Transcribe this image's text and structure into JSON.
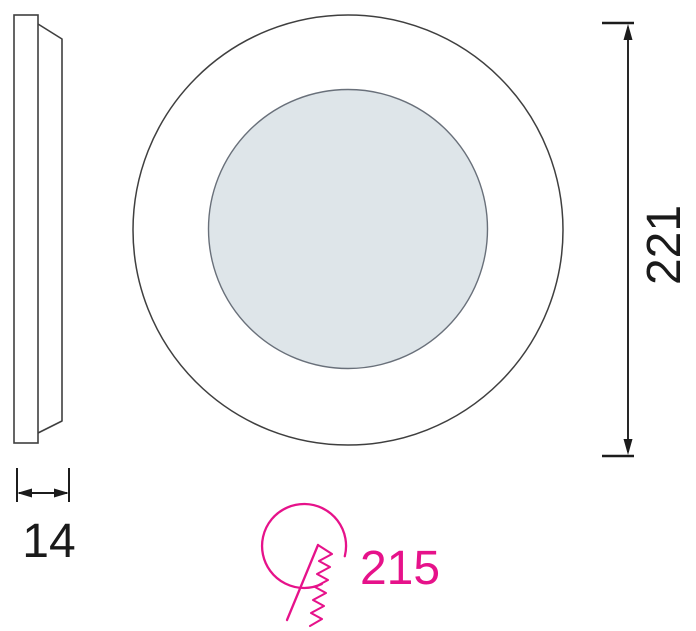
{
  "drawing": {
    "kind": "technical-dimension-drawing",
    "dimensions": {
      "thickness": "14",
      "diameter": "221",
      "cutout": "215"
    },
    "colors": {
      "line": "#3f3f3f",
      "dim_line": "#1c1c1c",
      "text": "#1a1a1a",
      "accent_pink": "#e6128a",
      "lens_fill": "#dee5e9",
      "lens_stroke": "#69707a",
      "background": "#ffffff"
    },
    "icons": {
      "cutout_icon": "saw-cutout-icon"
    }
  }
}
